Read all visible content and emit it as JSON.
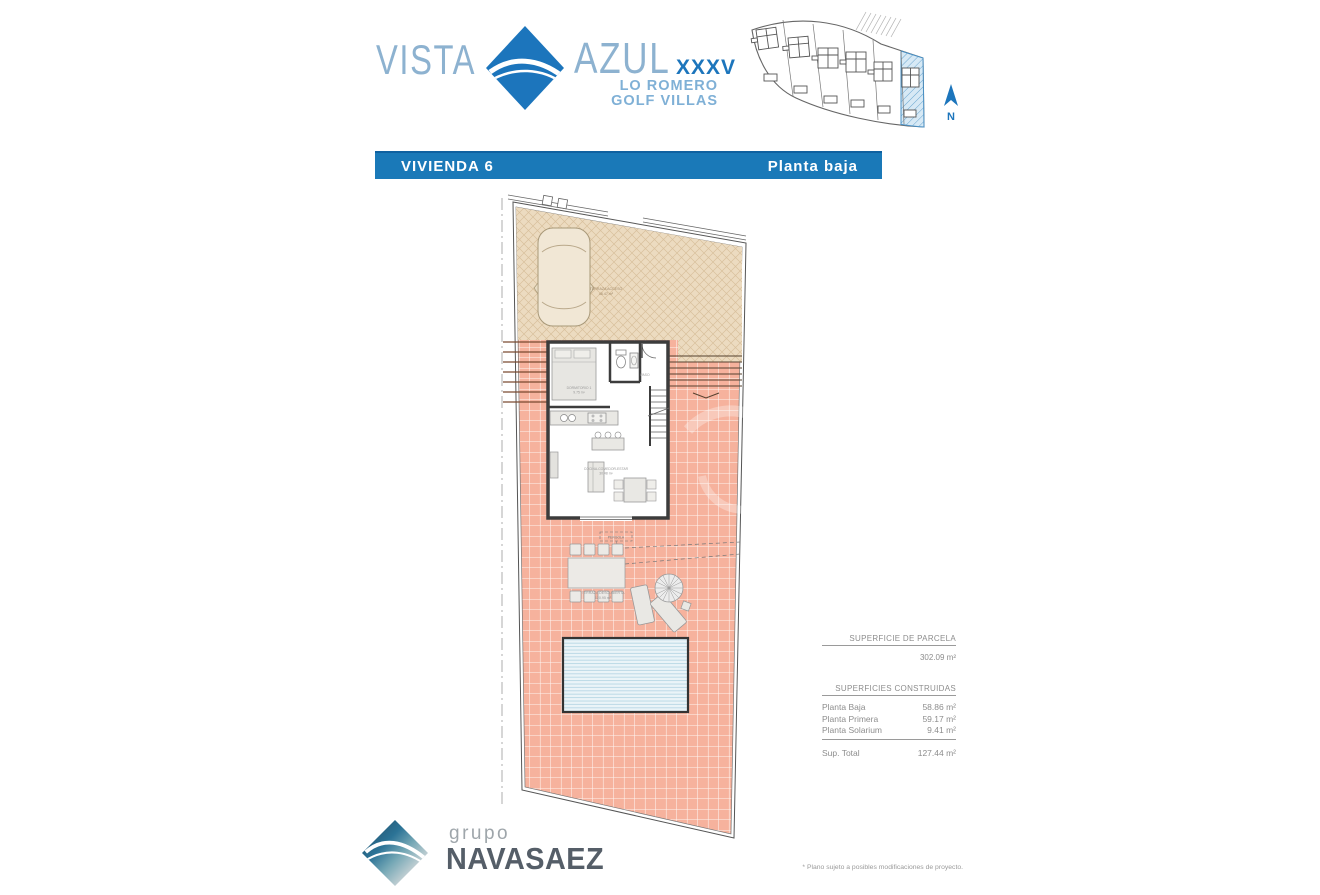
{
  "header": {
    "logo": {
      "word1": "VISTA",
      "word2": "AZUL",
      "numeral": "XXXV",
      "sub1": "LO ROMERO",
      "sub2": "GOLF VILLAS"
    },
    "siteplan": {
      "north_label": "N"
    }
  },
  "titlebar": {
    "left": "VIVIENDA   6",
    "right": "Planta  baja"
  },
  "plan": {
    "labels": {
      "terraza_acceso": "TERRAZA ACCESO",
      "terraza_acceso_area": "46.47 m²",
      "dormitorio": "DORMITORIO 1",
      "dormitorio_area": "9.75 m²",
      "paso": "PASO",
      "salon": "COCINA-COMEDOR-ESTAR",
      "salon_area": "30.48 m²",
      "pergola": "PERGOLA",
      "terraza_descubierta": "TERRAZA DESCUBIERTA",
      "terraza_descubierta_area": "120.95 m²"
    }
  },
  "surfaces": {
    "parcela_heading": "SUPERFICIE DE PARCELA",
    "parcela_value": "302.09 m²",
    "construidas_heading": "SUPERFICIES CONSTRUIDAS",
    "rows": [
      {
        "label": "Planta Baja",
        "value": "58.86 m²"
      },
      {
        "label": "Planta Primera",
        "value": "59.17 m²"
      },
      {
        "label": "Planta Solarium",
        "value": "9.41 m²"
      }
    ],
    "total_label": "Sup. Total",
    "total_value": "127.44 m²"
  },
  "footer": {
    "logo_top": "grupo",
    "logo_main": "NAVASAEZ",
    "note": "* Plano sujeto a posibles modificaciones de proyecto."
  },
  "colors": {
    "accent_blue": "#1c75bc",
    "bar_blue": "#1a79b8",
    "salmon_tile": "#f6b29d",
    "beige_hatch": "#ecdbc0",
    "pool_blue": "#eaf4f8",
    "logo_gray": "#555e68"
  }
}
